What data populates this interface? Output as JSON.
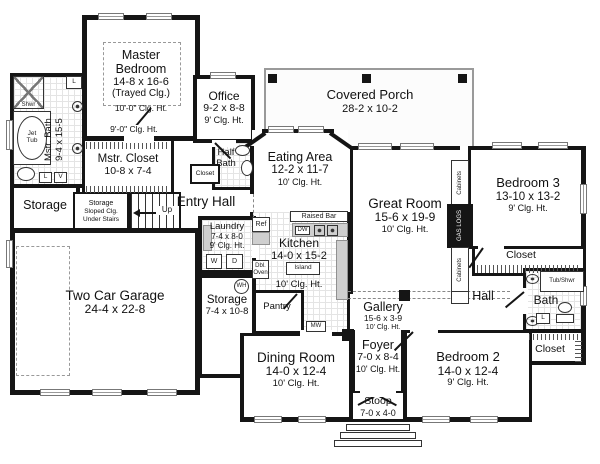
{
  "rooms": {
    "master_bedroom": {
      "name": "Master Bedroom",
      "dims": "14-8 x 16-6",
      "tray": "(Trayed Clg.)",
      "clg": "10'-0\" Clg. Ht."
    },
    "master_closet_clg": "9'-0\" Clg. Ht.",
    "mstr_bath": {
      "name": "Mstr. Bath",
      "dims": "9-4 x 15-5"
    },
    "mstr_closet": {
      "name": "Mstr. Closet",
      "dims": "10-8 x 7-4"
    },
    "storage_left": {
      "name": "Storage"
    },
    "storage_stairs": {
      "l1": "Storage",
      "l2": "Sloped Clg.",
      "l3": "Under Stairs"
    },
    "up": "Up",
    "office": {
      "name": "Office",
      "dims": "9-2 x 8-8",
      "clg": "9' Clg. Ht."
    },
    "half_bath": {
      "l1": "Half",
      "l2": "Bath"
    },
    "closet_office": {
      "name": "Closet"
    },
    "entry_hall": {
      "name": "Entry Hall"
    },
    "covered_porch": {
      "name": "Covered Porch",
      "dims": "28-2 x 10-2"
    },
    "eating_area": {
      "name": "Eating Area",
      "dims": "12-2 x 11-7",
      "clg": "10' Clg. Ht."
    },
    "great_room": {
      "name": "Great Room",
      "dims": "15-6 x 19-9",
      "clg": "10' Clg. Ht."
    },
    "bedroom3": {
      "name": "Bedroom 3",
      "dims": "13-10 x 13-2",
      "clg": "9' Clg. Ht."
    },
    "closet_b3": {
      "name": "Closet"
    },
    "hall": {
      "name": "Hall"
    },
    "bath": {
      "name": "Bath"
    },
    "closet_b2": {
      "name": "Closet"
    },
    "gallery": {
      "name": "Gallery",
      "dims": "15-6 x 3-9",
      "clg": "10' Clg. Ht."
    },
    "foyer": {
      "name": "Foyer",
      "dims": "7-0 x 8-4",
      "clg": "10' Clg. Ht."
    },
    "bedroom2": {
      "name": "Bedroom 2",
      "dims": "14-0 x 12-4",
      "clg": "9' Clg. Ht."
    },
    "stoop": {
      "name": "Stoop",
      "dims": "7-0 x 4-0"
    },
    "dining": {
      "name": "Dining Room",
      "dims": "14-0 x 12-4",
      "clg": "10' Clg. Ht."
    },
    "kitchen": {
      "name": "Kitchen",
      "dims": "14-0 x 15-2",
      "clg": "10' Clg. Ht."
    },
    "laundry": {
      "name": "Laundry",
      "dims": "7-4 x 8-0",
      "clg": "9' Clg. Ht."
    },
    "storage_mid": {
      "name": "Storage",
      "dims": "7-4 x 10-8"
    },
    "garage": {
      "name": "Two Car Garage",
      "dims": "24-4 x 22-8"
    },
    "pantry": {
      "name": "Pantry"
    }
  },
  "fixtures": {
    "shwr": "Shwr",
    "jet_tub_l1": "Jet",
    "jet_tub_l2": "Tub",
    "linen": "L",
    "vanity": "V",
    "washer": "W",
    "dryer": "D",
    "water_heater": "WH",
    "ref": "Ref",
    "dw": "DW",
    "dbl_oven_l1": "Dbl.",
    "dbl_oven_l2": "Oven",
    "island": "Island",
    "mw": "MW",
    "raised_bar": "Raised Bar",
    "cabinets": "Cabinets",
    "gas_logs": "GAS LOGS",
    "tub_shwr": "Tub/Shwr"
  },
  "colors": {
    "wall": "#151515",
    "tile_line": "#e4e4e4",
    "porch_line": "#9a9a9a"
  }
}
